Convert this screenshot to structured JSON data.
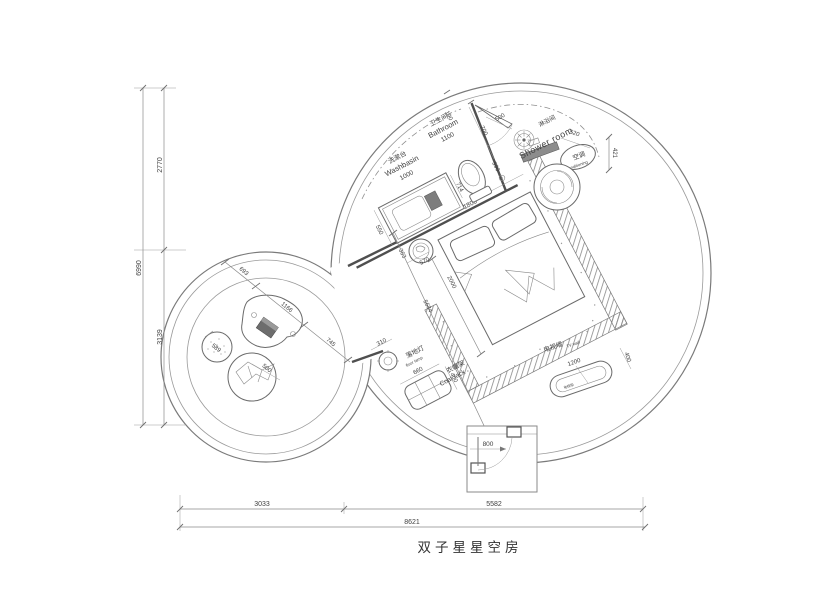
{
  "title": "双子星星空房",
  "labels": {
    "washbasin_zh": "洗漱台",
    "washbasin_en": "Washbasin",
    "washbasin_dim": "1000",
    "bathroom_zh": "卫生间",
    "bathroom_en": "Bathroom",
    "bathroom_dim": "1100",
    "shower_zh": "淋浴间",
    "shower_en": "Shower room",
    "ac_zh": "空调",
    "ac_en": "air-conditioning",
    "floorlamp_zh": "落地灯",
    "floorlamp_en": "floor lamp",
    "coatrack_zh": "衣帽架",
    "coatrack_en": "Coat rack",
    "tvwall_zh": "电视墙",
    "tvwall_en": "TV wall",
    "tv_cabinet": "电视柜"
  },
  "dims": {
    "left_total": "6990",
    "left_top": "2770",
    "left_bottom": "3139",
    "bottom_left": "3033",
    "bottom_right": "5582",
    "bottom_total": "8621",
    "wall_seg": "190",
    "bath_wall": "700",
    "shower_door": "500",
    "shower_drain": "590",
    "toilet_offset": "714",
    "counter_depth": "550",
    "bed_width": "1800",
    "stool_a": "363",
    "stool_b": "570",
    "bed_length": "2000",
    "side_total": "5684",
    "ac_width": "520",
    "ac_height": "421",
    "lamp": "310",
    "coat_w": "660",
    "coat_d": "400",
    "tv_w": "1200",
    "tv_d": "400",
    "lounge_a": "693",
    "lounge_b": "1166",
    "lounge_c": "745",
    "lounge_circle": "589",
    "cushion": "500",
    "entry_door": "800"
  }
}
